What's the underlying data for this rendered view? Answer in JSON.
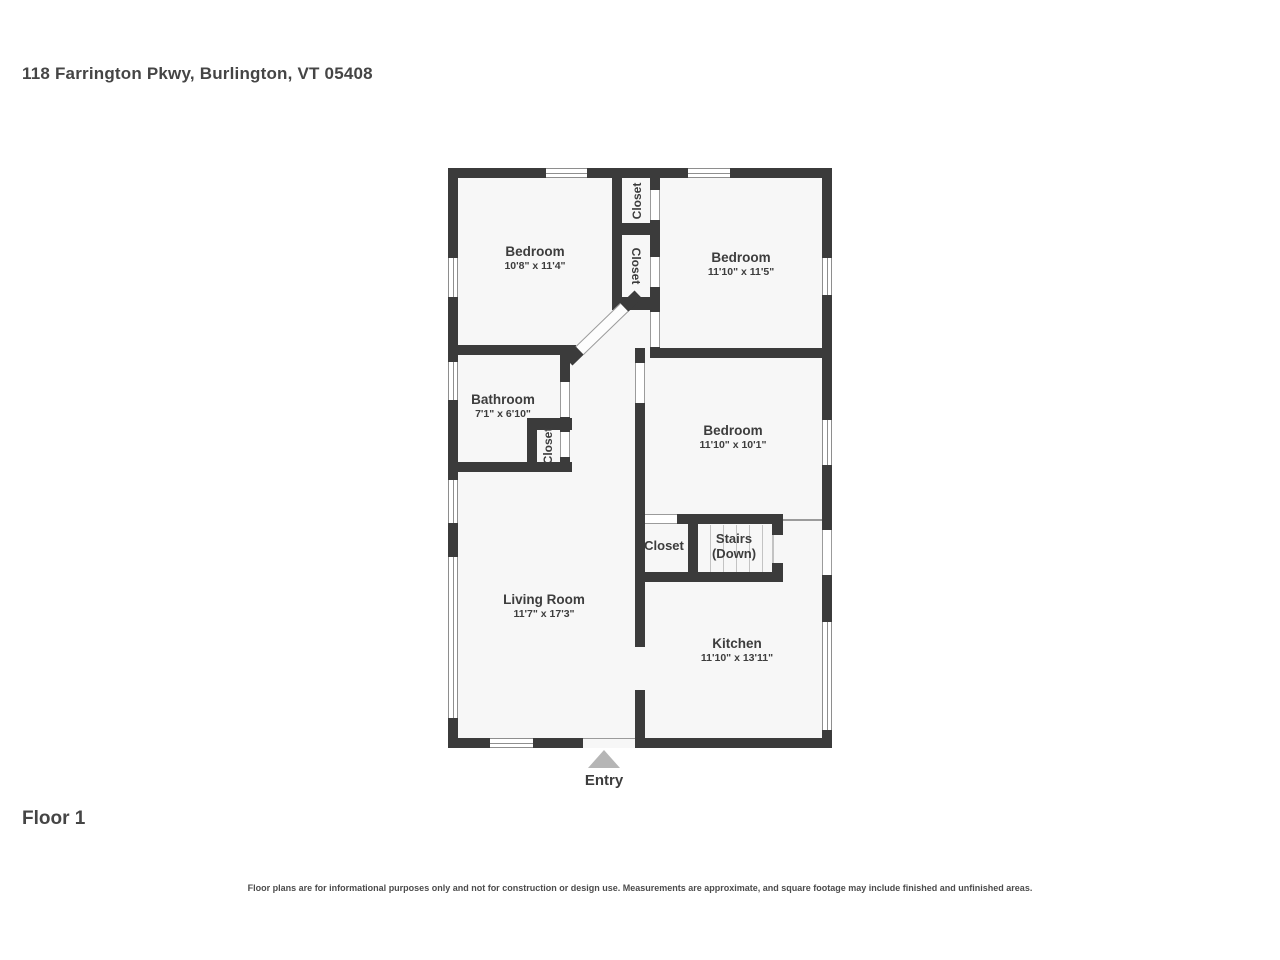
{
  "page": {
    "address": "118 Farrington Pkwy, Burlington, VT 05408",
    "floor_label": "Floor 1",
    "disclaimer": "Floor plans are for informational purposes only and not for construction or design use. Measurements are approximate, and square footage may include finished and unfinished areas."
  },
  "colors": {
    "wall": "#3b3b3b",
    "room_fill": "#f7f7f7",
    "label_text": "#3d3d3d",
    "entry_arrow": "#b5b5b5"
  },
  "rooms": [
    {
      "name": "Bedroom",
      "dimensions": "10'8\" x 11'4\""
    },
    {
      "name": "Bedroom",
      "dimensions": "11'10\" x 11'5\""
    },
    {
      "name": "Bathroom",
      "dimensions": "7'1\" x 6'10\""
    },
    {
      "name": "Bedroom",
      "dimensions": "11'10\" x 10'1\""
    },
    {
      "name": "Living Room",
      "dimensions": "11'7\" x 17'3\""
    },
    {
      "name": "Kitchen",
      "dimensions": "11'10\" x 13'11\""
    }
  ],
  "closet_labels": [
    "Closet",
    "Closet",
    "Closet",
    "Closet"
  ],
  "stairs": {
    "line1": "Stairs",
    "line2": "(Down)"
  },
  "entry_label": "Entry"
}
